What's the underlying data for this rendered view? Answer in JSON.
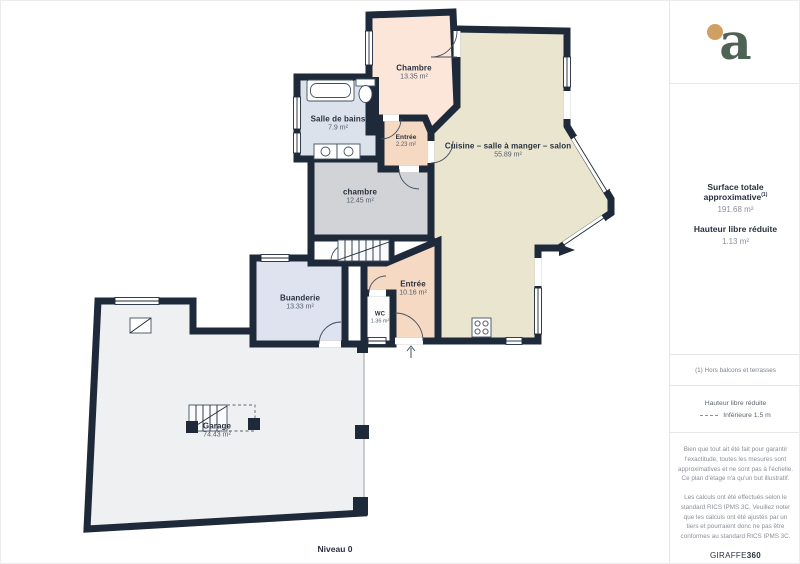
{
  "plan": {
    "level_label": "Niveau 0",
    "rooms": [
      {
        "name": "Chambre",
        "area": "13.35 m²"
      },
      {
        "name": "Salle de bains",
        "area": "7.9 m²"
      },
      {
        "name": "Entrée",
        "area": "2.23 m²"
      },
      {
        "name": "chambre",
        "area": "12.45 m²"
      },
      {
        "name": "Cuisine – salle à manger – salon",
        "area": "55.89 m²"
      },
      {
        "name": "Buanderie",
        "area": "13.33 m²"
      },
      {
        "name": "Entrée",
        "area": "10.16 m²"
      },
      {
        "name": "WC",
        "area": "1.36 m²"
      },
      {
        "name": "Garage",
        "area": "74.43 m²"
      }
    ],
    "colors": {
      "wall": "#1e2a39",
      "peach_light": "#fce6d9",
      "peach": "#f6d9c2",
      "gray_room": "#d2d3d6",
      "blue_room": "#dce2eb",
      "blue_room2": "#dfe3f0",
      "cream": "#eae5cf",
      "garage": "#eef0f1",
      "white_room": "#fdfdfd",
      "logo_green": "#4d6355",
      "logo_gold": "#cf9f63"
    }
  },
  "sidebar": {
    "logo_letter": "a",
    "metrics": {
      "surface_label": "Surface totale approximative",
      "surface_footnote_marker": "(1)",
      "surface_value": "191.68 m²",
      "height_label": "Hauteur libre réduite",
      "height_value": "1.13 m²"
    },
    "footnote": "(1) Hors balcons et terrasses",
    "legend": {
      "title": "Hauteur libre réduite",
      "item": "Inférieure 1.5 m"
    },
    "disclaimers": [
      "Bien que tout ait été fait pour garantir l'exactitude, toutes les mesures sont approximatives et ne sont pas à l'échelle. Ce plan d'étage n'a qu'un but illustratif.",
      "Les calculs ont été effectués selon le standard RICS IPMS 3C. Veuillez noter que les calculs ont été ajustés par un tiers et pourraient donc ne pas être conformes au standard RICS IPMS 3C."
    ],
    "brand": {
      "name": "GIRAFFE",
      "suffix": "360"
    }
  }
}
